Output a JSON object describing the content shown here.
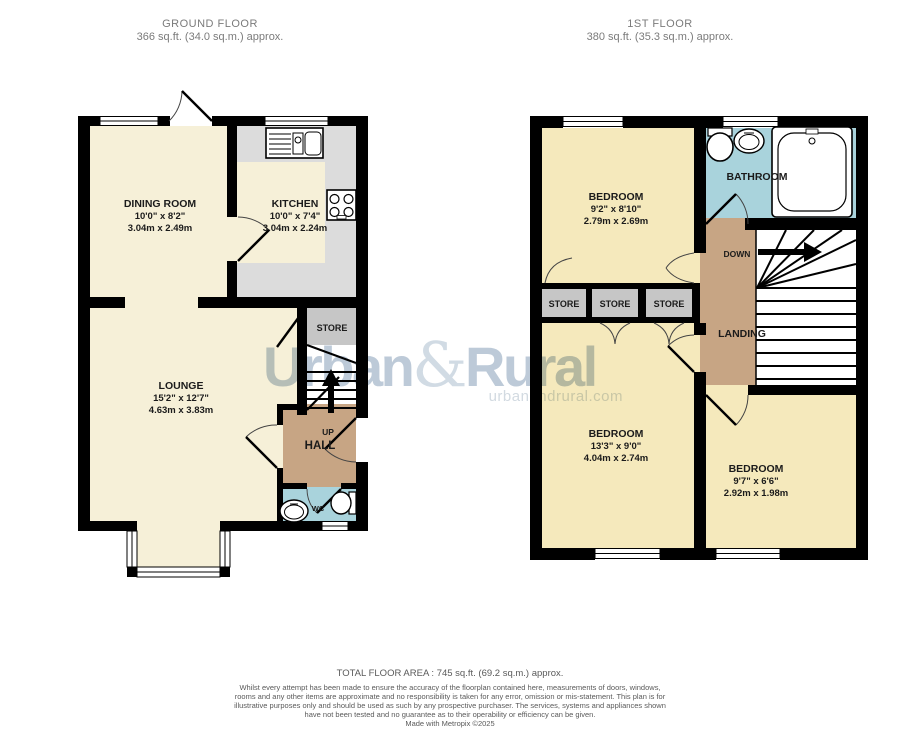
{
  "ground_floor": {
    "title": "GROUND FLOOR",
    "area": "366 sq.ft. (34.0 sq.m.) approx.",
    "rooms": {
      "dining_room": {
        "name": "DINING ROOM",
        "dims_imperial": "10'0\" x 8'2\"",
        "dims_metric": "3.04m x 2.49m"
      },
      "kitchen": {
        "name": "KITCHEN",
        "dims_imperial": "10'0\" x 7'4\"",
        "dims_metric": "3.04m x 2.24m"
      },
      "lounge": {
        "name": "LOUNGE",
        "dims_imperial": "15'2\" x 12'7\"",
        "dims_metric": "4.63m x 3.83m"
      },
      "store": {
        "name": "STORE"
      },
      "hall": {
        "name": "HALL"
      },
      "wc": {
        "name": "WC"
      },
      "stairs_label": "UP"
    }
  },
  "first_floor": {
    "title": "1ST FLOOR",
    "area": "380 sq.ft. (35.3 sq.m.) approx.",
    "rooms": {
      "bedroom_1": {
        "name": "BEDROOM",
        "dims_imperial": "9'2\" x 8'10\"",
        "dims_metric": "2.79m x 2.69m"
      },
      "bathroom": {
        "name": "BATHROOM"
      },
      "store_1": {
        "name": "STORE"
      },
      "store_2": {
        "name": "STORE"
      },
      "store_3": {
        "name": "STORE"
      },
      "landing": {
        "name": "LANDING"
      },
      "bedroom_2": {
        "name": "BEDROOM",
        "dims_imperial": "13'3\" x 9'0\"",
        "dims_metric": "4.04m x 2.74m"
      },
      "bedroom_3": {
        "name": "BEDROOM",
        "dims_imperial": "9'7\" x 6'6\"",
        "dims_metric": "2.92m x 1.98m"
      },
      "stairs_label": "DOWN"
    }
  },
  "watermark": {
    "brand_part1": "Urban",
    "brand_amp": "&",
    "brand_part2": "Rural",
    "website": "urbanandrural.com"
  },
  "footer": {
    "total_area": "TOTAL FLOOR AREA : 745 sq.ft. (69.2 sq.m.) approx.",
    "disclaimer": "Whilst every attempt has been made to ensure the accuracy of the floorplan contained here, measurements of doors, windows, rooms and any other items are approximate and no responsibility is taken for any error, omission or mis-statement. This plan is for illustrative purposes only and should be used as such by any prospective purchaser. The services, systems and appliances shown have not been tested and no guarantee as to their operability or efficiency can be given.",
    "credit": "Made with Metropix ©2025"
  },
  "colors": {
    "room_cream": "#F6F0D8",
    "room_yellow": "#F5E9BC",
    "kitchen_gray": "#DCDCDC",
    "store_gray": "#C6C6C6",
    "hall_tan": "#C7A584",
    "bath_blue": "#A9D3DC",
    "wall_black": "#000000",
    "watermark_blue": "#B4C3D3"
  }
}
